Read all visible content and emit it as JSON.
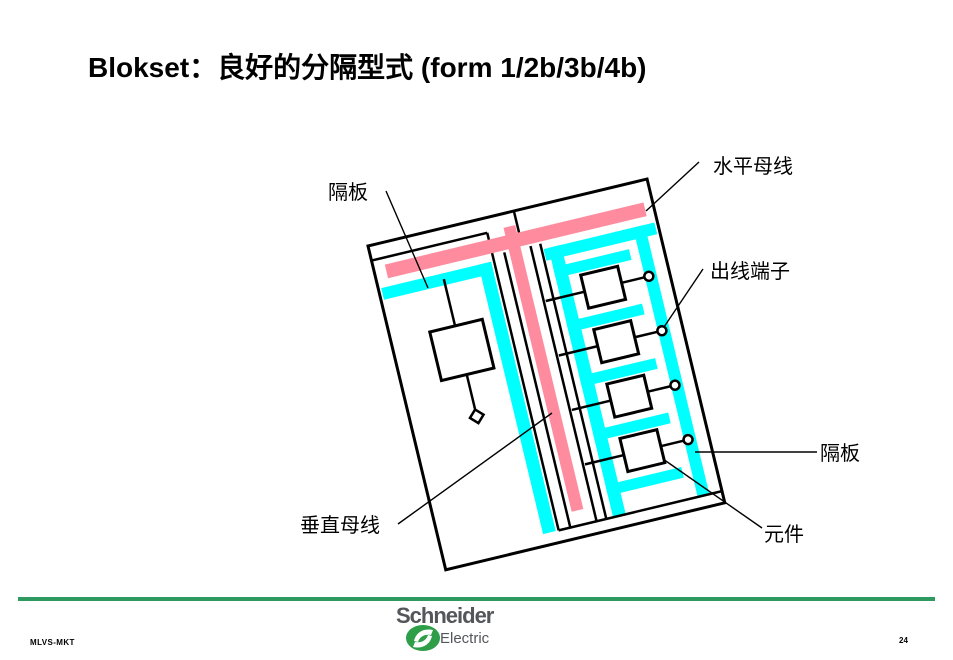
{
  "slide": {
    "title": "Blokset：良好的分隔型式 (form 1/2b/3b/4b)"
  },
  "diagram": {
    "labels": {
      "partition_top": "隔板",
      "horizontal_busbar": "水平母线",
      "outgoing_terminals": "出线端子",
      "partition_right": "隔板",
      "component": "元件",
      "vertical_busbar": "垂直母线"
    },
    "colors": {
      "busbar_pink": "#FF8C9E",
      "partition_cyan": "#00FFFF",
      "line_black": "#000000"
    }
  },
  "footer": {
    "department": "MLVS-MKT",
    "page_number": "24",
    "logo_brand": "Schneider",
    "logo_sub": "Electric",
    "rule_color": "#2F9A60",
    "logo_green": "#2E9E49",
    "logo_gray": "#53565A"
  }
}
